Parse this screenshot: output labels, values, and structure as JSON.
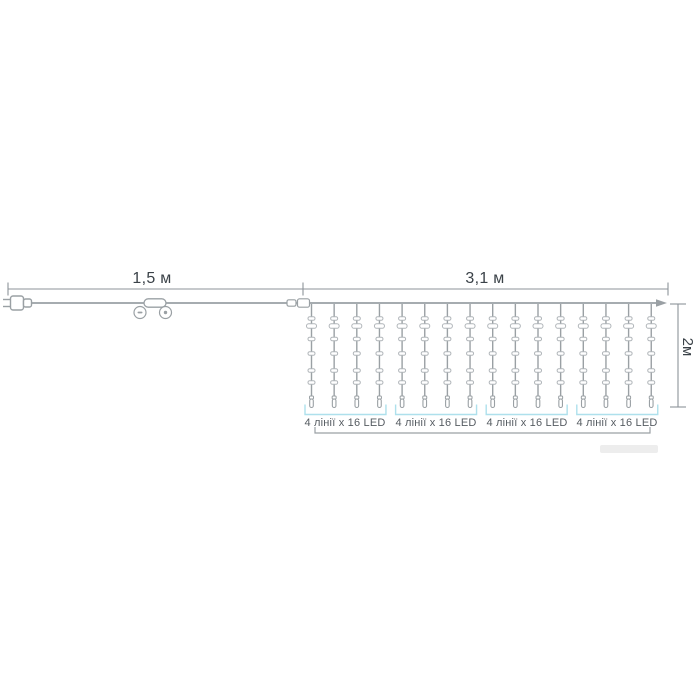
{
  "diagram": {
    "dimensions": {
      "lead_cable_length": "1,5 м",
      "curtain_width": "3,1 м",
      "curtain_height": "2м"
    },
    "groups": [
      {
        "label": "4 лінії x 16 LED"
      },
      {
        "label": "4 лінії x 16 LED"
      },
      {
        "label": "4 лінії x 16 LED"
      },
      {
        "label": "4 лінії x 16 LED"
      }
    ],
    "structure": {
      "group_count": 4,
      "lines_per_group": 4,
      "leds_per_group": 16,
      "total_lines": 16
    },
    "colors": {
      "wire": "#9aa0a4",
      "dimension": "#8d9399",
      "text": "#3b4248",
      "group_text": "#565c62",
      "group_box": "#aee0ec",
      "led_stroke": "#b0b5b9",
      "bracket": "#9aa0a5",
      "watermark": "#ededed"
    }
  }
}
